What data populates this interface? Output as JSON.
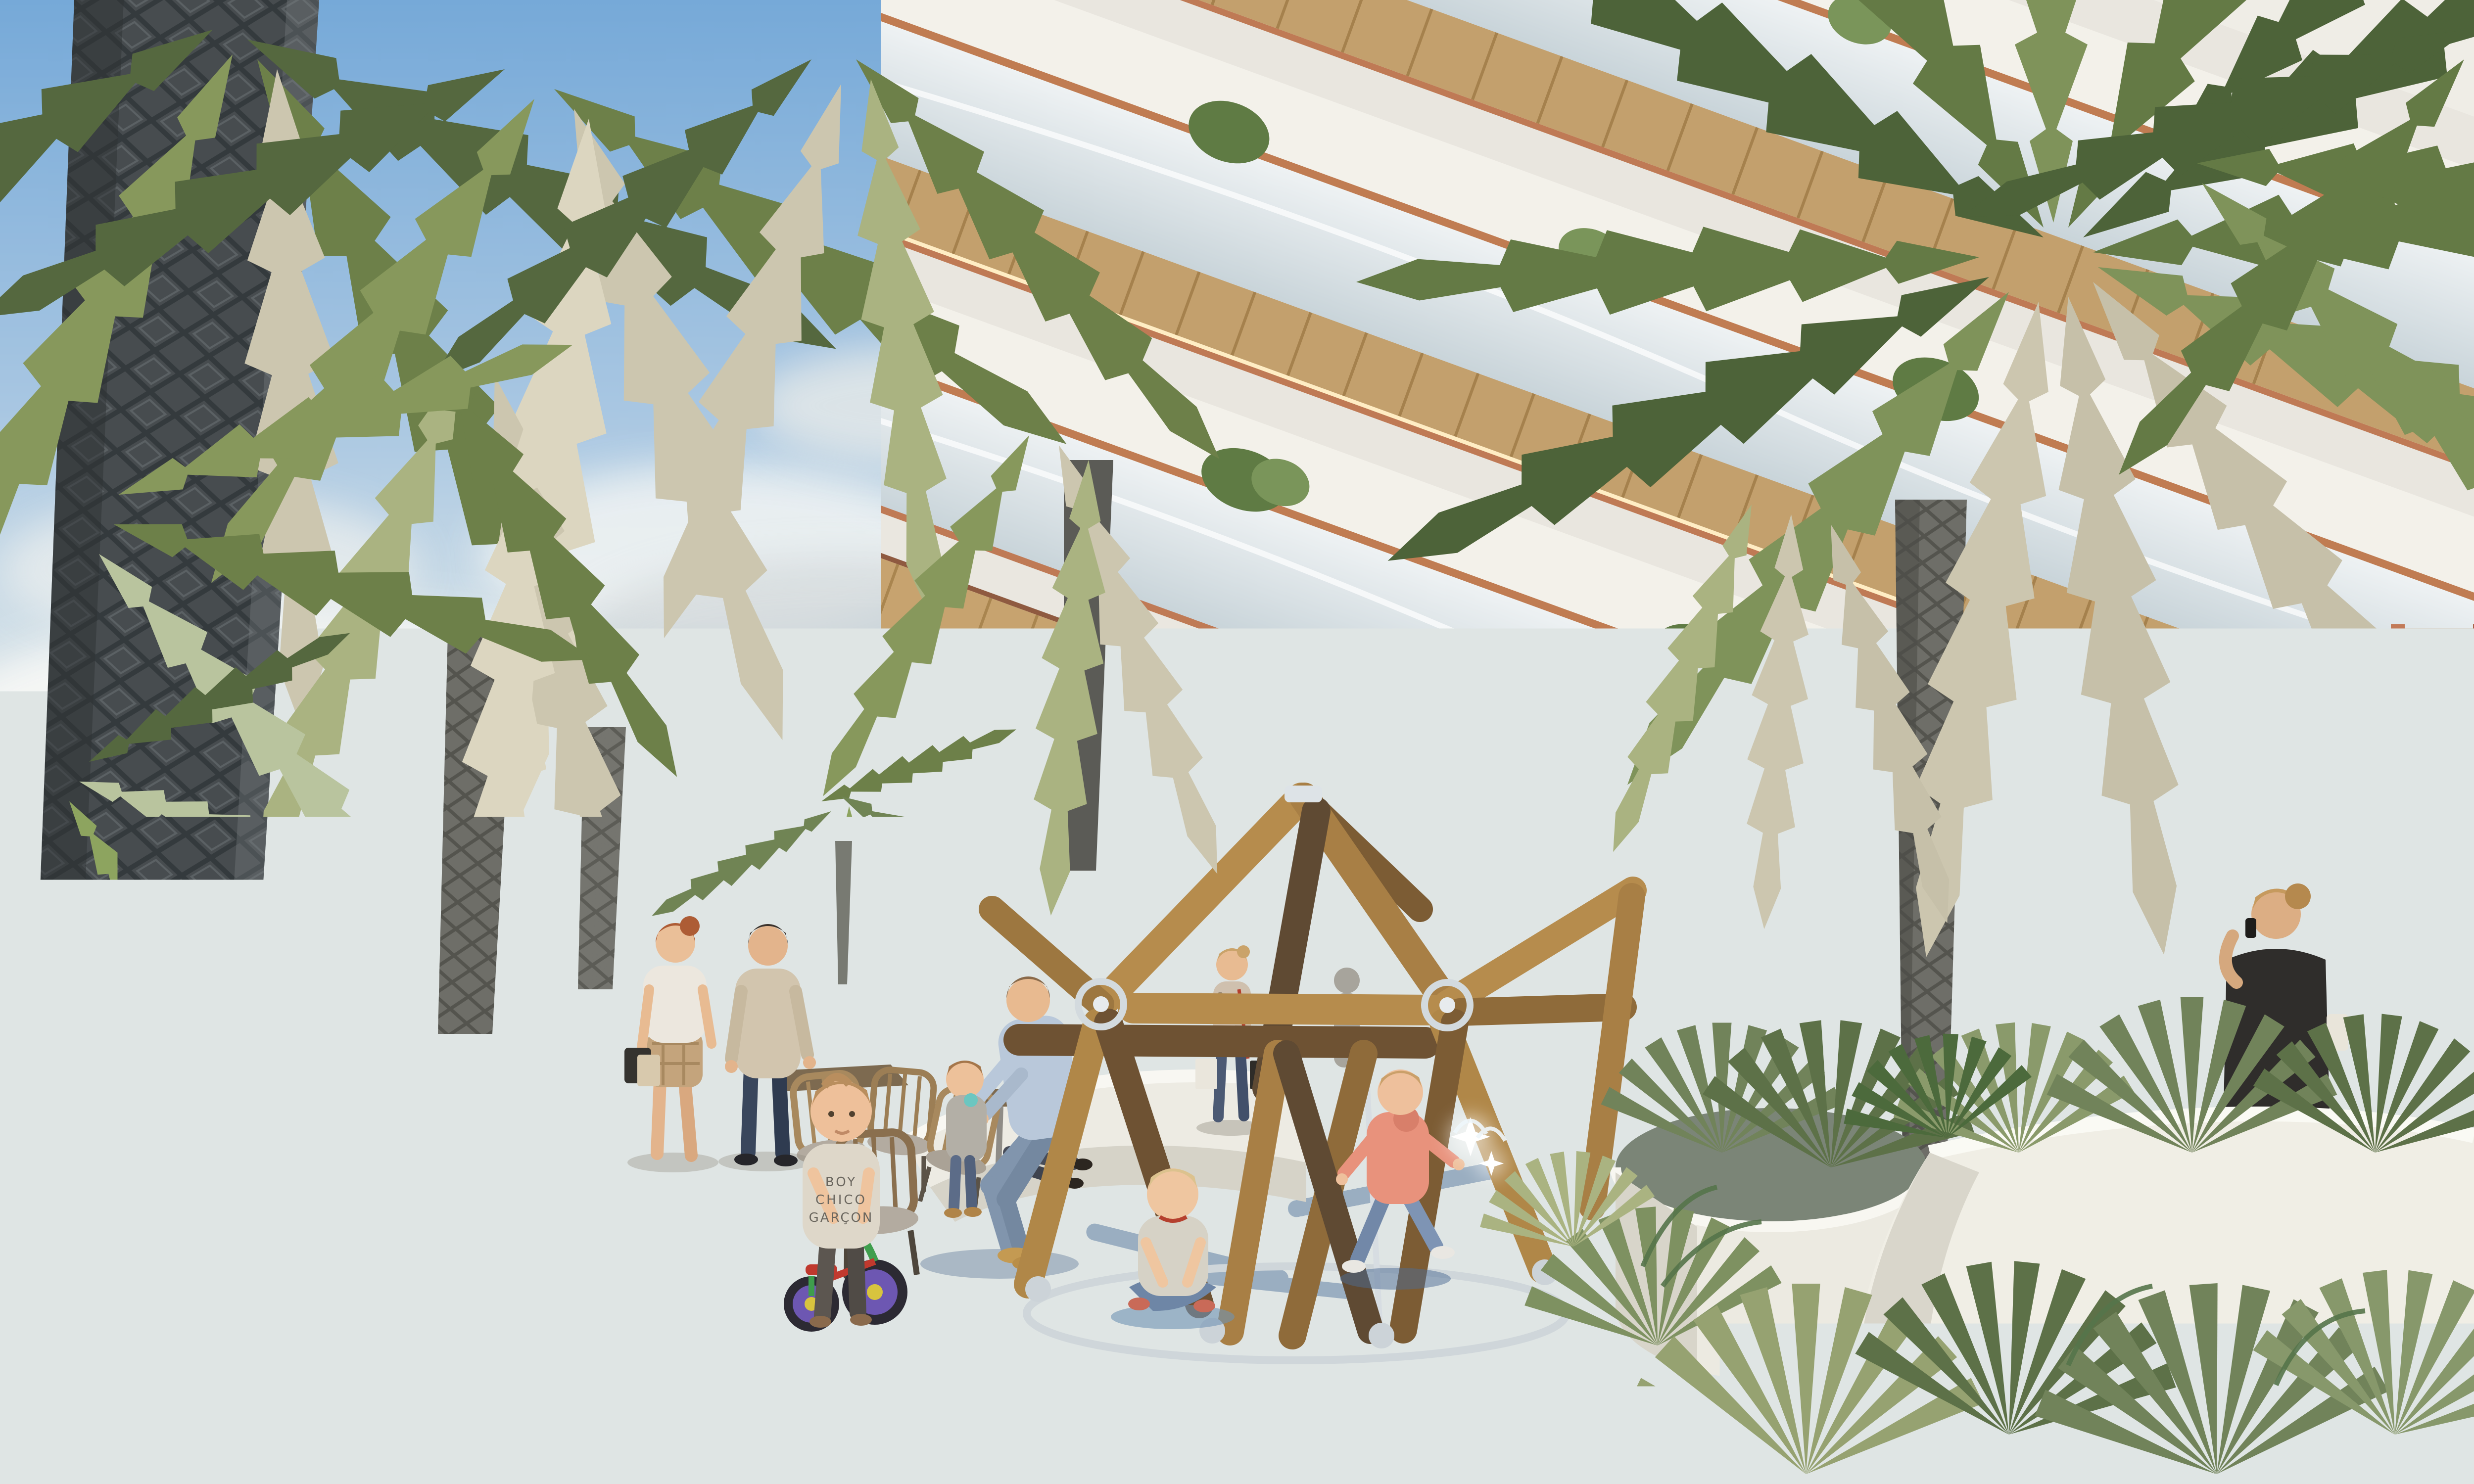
{
  "scene": {
    "kind": "photorealistic architectural rendering",
    "description": "Sunny palm-filled courtyard of a modern tropical residence with curved white balconies; children play around a timber climbing dome on a blue splash pad while adults relax nearby",
    "time_of_day": "late afternoon, warm sunlight",
    "weather": "partly cloudy blue sky"
  },
  "palette": {
    "sky_top": "#76a9d8",
    "sky_horizon": "#edf0ec",
    "cloud_white": "#f7f8f6",
    "facade_white": "#efede6",
    "terrazzo_white": "#f0eee5",
    "wood_soffit": "#c7a36f",
    "copper_trim": "#bf7a55",
    "glass_balustrade": "#dfe7ea",
    "entrance_frame_terracotta": "#b06a50",
    "paver_cream": "#e9e5da",
    "path_blue": "#5e7ca4",
    "path_shadow_blue": "#41597f",
    "splash_pad_blue": "#a7cbdf",
    "beam_wood_light": "#b68c4d",
    "beam_wood_dark": "#6e5233",
    "steel_silver": "#d3dade",
    "palm_green_dark": "#4d6339",
    "palm_green_mid": "#6d8049",
    "palm_green_light": "#8da45f",
    "palm_silver": "#ccc6af",
    "trunk_dark": "#474c4f",
    "flower_pink": "#e2a2b4",
    "skin": "#eabc93"
  },
  "building": {
    "style": "organic curved balcony slabs seen from below",
    "materials": [
      "white terrazzo slabs",
      "timber slat soffits with cove lighting",
      "copper trim bands",
      "frameless glass balustrades"
    ],
    "balcony_levels_visible": 4,
    "balcony_planters": "small palms and grasses on each level",
    "entrance": {
      "frame": "terracotta framed glass doors and transoms",
      "interior": "warm lit lobby flower shop with pink blooms",
      "canopy": "timber slat soffit with downlights"
    },
    "right_wing": "shaded ground-floor terrace with white walls, doors and a copper framed window"
  },
  "playground": {
    "structure": "geodesic climbing dome of hardwood beams",
    "connectors": "stainless steel rings and plate joints",
    "base": "polished steel ring anchored on splash pad",
    "splash_pad": "light blue circular pad with water jets",
    "path": "deep blue rubber play path with palm shadows winding through cream pavers"
  },
  "vegetation": {
    "palms": "date palms with diamond-cut dark trunks and silvery-green fronds",
    "accent_trees": [
      "pink crape myrtle in bloom",
      "frangipani over white planter boxes"
    ],
    "planting": [
      "fan palms",
      "ferns",
      "tropical shrubs in white terrazzo planters"
    ]
  },
  "people": [
    {
      "id": "girl-skateboard",
      "where": "foreground left",
      "look": "girl with blue bandana headband, green sweater, cream pants, holding teal skateboard with yellow wheels"
    },
    {
      "id": "boy-skateboard",
      "where": "foreground center-left",
      "look": "boy with shaggy blond hair, olive long-sleeve shirt, jeans, teal skateboard behind his back"
    },
    {
      "id": "toddler-green-trike",
      "where": "center-left",
      "look": "toddler in tee printed BOY CHICO GARÇON pushing a green trike with purple wheels"
    },
    {
      "id": "toddler-blue-trike",
      "where": "center",
      "look": "blond toddler in olive overalls riding a blue trike"
    },
    {
      "id": "woman-shopper",
      "where": "mid-ground left",
      "look": "red-haired woman in white top and plaid shorts carrying bags"
    },
    {
      "id": "man-standing",
      "where": "mid-ground left",
      "look": "man in beige sweater and navy trousers"
    },
    {
      "id": "father-and-toddler",
      "where": "center on planter edge",
      "look": "father in light blue shirt and jeans sitting on planter, toddler with teal cup standing in front"
    },
    {
      "id": "child-pink-hoodie",
      "where": "running through dome",
      "look": "small child in salmon hoodie and jeans"
    },
    {
      "id": "toddler-sitting",
      "where": "inside dome on splash pad",
      "look": "blond toddler sitting cross-legged"
    },
    {
      "id": "woman-shopping-bags",
      "where": "at lobby entrance",
      "look": "woman in patterned blouse and jeans with shopping bags"
    },
    {
      "id": "woman-on-phone",
      "where": "right shaded terrace",
      "look": "blonde woman in black top talking on phone behind white wall"
    }
  ],
  "labels": {
    "shirt_line1": "BOY",
    "shirt_line2": "CHICO",
    "shirt_line3": "GARÇON"
  }
}
